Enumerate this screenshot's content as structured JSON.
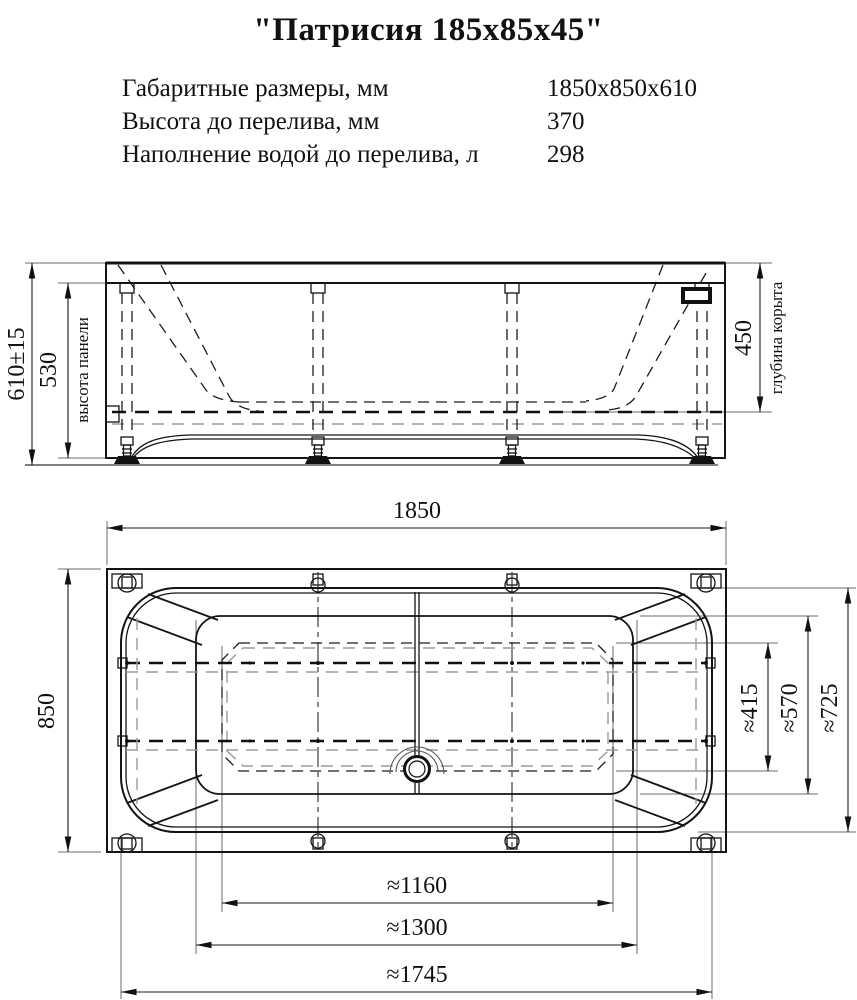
{
  "title": "\"Патрисия 185х85х45\"",
  "specs": [
    {
      "label": "Габаритные размеры, мм",
      "value": "1850х850х610"
    },
    {
      "label": "Высота до перелива, мм",
      "value": "370"
    },
    {
      "label": "Наполнение водой до перелива, л",
      "value": "298"
    }
  ],
  "front_view": {
    "total_height": "610±15",
    "panel_height": "530",
    "panel_height_label": "высота панели",
    "bowl_depth": "450",
    "bowl_depth_label": "глубина корыта"
  },
  "top_view": {
    "overall_length": "1850",
    "overall_width": "850",
    "floor_width": "≈415",
    "bowl_width": "≈570",
    "rim_width": "≈725",
    "floor_length": "≈1160",
    "bowl_length": "≈1300",
    "rim_length": "≈1745"
  }
}
